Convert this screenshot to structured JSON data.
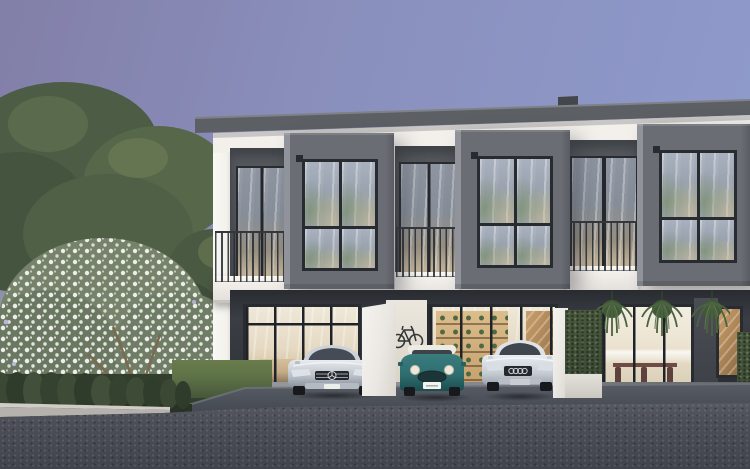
{
  "scene": {
    "type": "architectural exterior rendering",
    "time_of_day": "dusk",
    "setting": "Modern two-storey townhouse row with warm lit interiors, flowering tree and hedges on the left, three cars parked in front car bays, asphalt road in the foreground",
    "sky": "clear dusk sky graded from purple to periwinkle blue with a pale green glow at the horizon",
    "vegetation": {
      "left_trees": "dense green trees behind a large white-flowering shrub",
      "flowering_shrub": "shrub covered in small white blossoms with thin branching trunks",
      "hedge_row": "row of trimmed bushes along the kerb",
      "planter_hedge": "clipped hedge screen on a white planter between car bays",
      "hanging_plants": "three hanging ferns above the dining-room glazing",
      "lawn": "strip of lawn between hedge row and driveway"
    },
    "building": {
      "storeys": 2,
      "visible_units": 3,
      "style": "white facade with protruding charcoal-grey window boxes, flat roof, white cornice",
      "second_floor": "three boxed picture windows reflecting trees and sky, recessed balconies with thin vertical balusters and glass sliding doors",
      "ground_floor_unit_1": "living room behind full-height glazing with curtains and sofa, car bay in front",
      "ground_floor_unit_2": "double car bay with wall-mounted bicycle, timber shelving unit and staircase behind glazing",
      "ground_floor_unit_3": "dining room with timber table and chairs, white kitchen, timber staircase window at far right"
    },
    "cars": [
      {
        "name": "mercedes-sedan",
        "color_name": "silver",
        "position": "left car bay",
        "logo": "three-pointed star"
      },
      {
        "name": "mini-cooper",
        "color_name": "teal with white roof",
        "position": "middle car bay"
      },
      {
        "name": "audi-sedan",
        "color_name": "white",
        "position": "middle-right car bay",
        "logo": "four rings"
      }
    ],
    "foreground": {
      "kerb": "light grey kerb",
      "driveway": "dark grey driveway apron sloping to the road",
      "road": "dark speckled asphalt"
    }
  },
  "colors": {
    "sky_top_left": "#827fa8",
    "sky_top_right": "#8f9cce",
    "sky_horizon": "#aab3a2",
    "tree_dark": "#46553f",
    "tree_mid": "#5d6d4f",
    "blossom": "#e9eae4",
    "facade_white": "#efece7",
    "roof_grey": "#5c5f64",
    "roof_lip": "#7e8186",
    "box_grey": "#6a6e74",
    "box_grey_light": "#90939a",
    "recess_grey": "#56595e",
    "frame_dark": "#282b30",
    "glass_sky": "#a9b1bf",
    "glass_warm": "#d3c1a2",
    "interior_deep": "#c9b48e",
    "railing": "#34373c",
    "carport_floor": "#888b91",
    "driveway": "#4c5058",
    "road": "#4e525a",
    "road_deep": "#41444c",
    "curb": "#b5b2ad",
    "hedge": "#3e4b37",
    "lawn": "#5e7247",
    "fern": "#4c6340",
    "mini_teal": "#2e6e70",
    "audi_white": "#e9edf2",
    "mercedes_silver": "#c9ccd1"
  }
}
